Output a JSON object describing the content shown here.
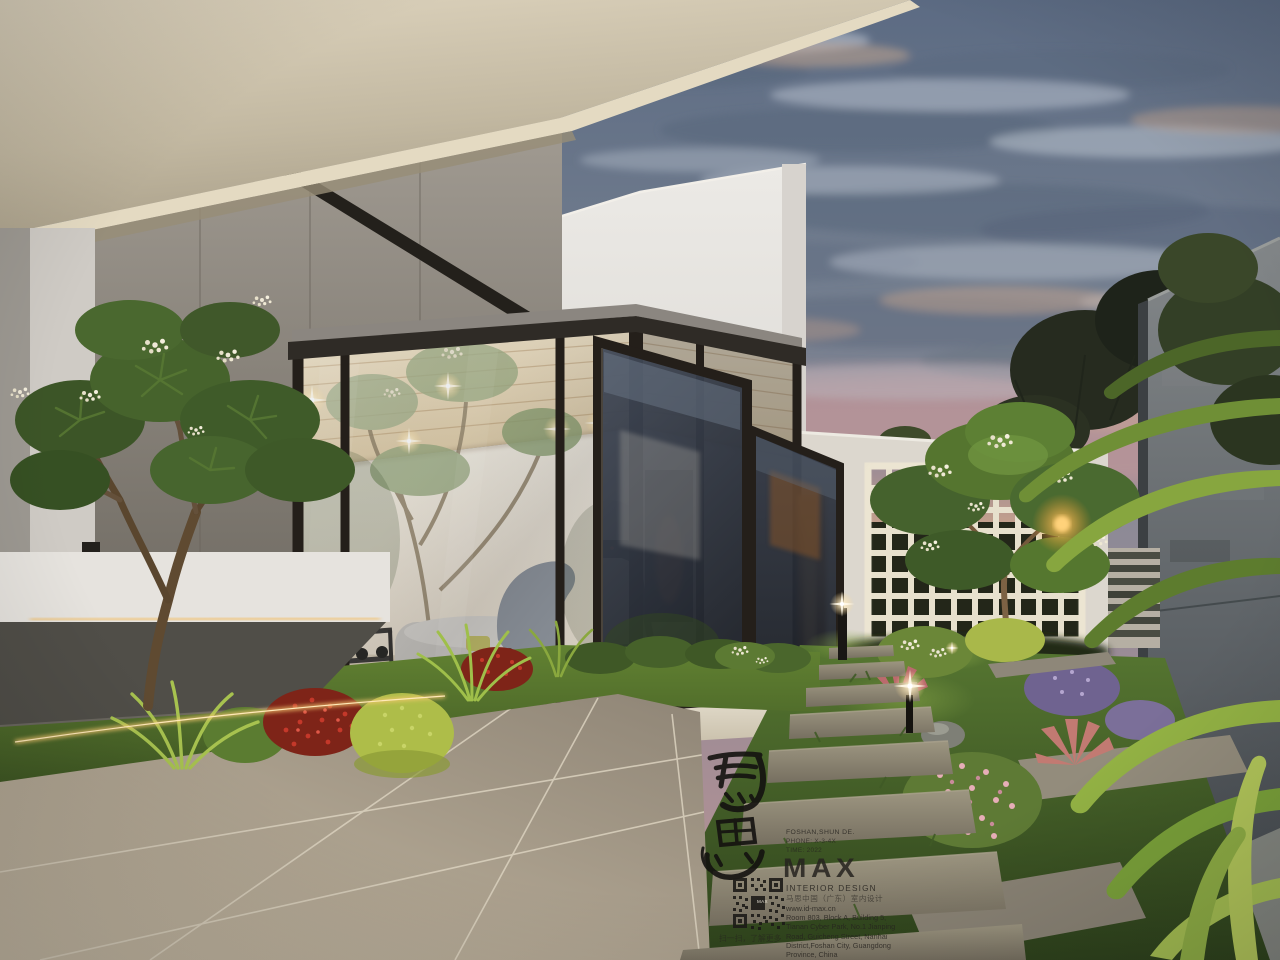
{
  "watermark": {
    "calligraphy": "馬思",
    "location_line": "FOSHAN,SHUN DE.",
    "info_line_2": "PHONE: X-3-4X",
    "info_line_3": "TIME: 2022",
    "brand": "MAX",
    "brand_subtitle": "INTERIOR DESIGN",
    "brand_chinese": "马思中国（广东）室内设计",
    "website": "www.id-max.cn",
    "address_lines": [
      "Room 803, Block A, Building 5,",
      "Tianan Cyber Park, No.1 Jianping",
      "Road, Guicheng Street, Nanhai",
      "District,Foshan City, Guangdong",
      "Province, China"
    ],
    "qr_caption": "扫一扫，了解更多"
  },
  "palette": {
    "sky_twilight": "#6E7D91",
    "sunset_pink": "#BD9595",
    "eave_beige": "#CFC5AE",
    "frame_black": "#241F1A",
    "warm_light": "#F5C46C",
    "foliage_green": "#55752F",
    "lawn_green": "#4A6528",
    "stone_tile": "#B6AA97",
    "wall_white": "#ECEAE6"
  }
}
